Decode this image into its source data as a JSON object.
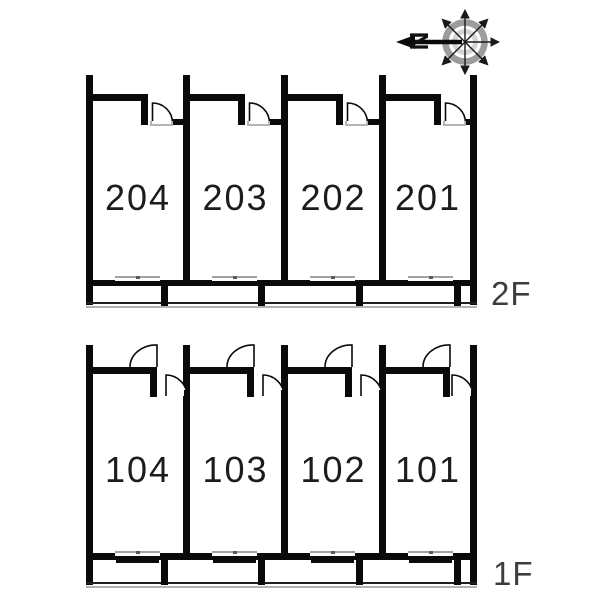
{
  "compass": {
    "north_label": "N"
  },
  "floors": [
    {
      "label": "2F",
      "units": [
        {
          "number": "204"
        },
        {
          "number": "203"
        },
        {
          "number": "202"
        },
        {
          "number": "201"
        }
      ]
    },
    {
      "label": "1F",
      "units": [
        {
          "number": "104"
        },
        {
          "number": "103"
        },
        {
          "number": "102"
        },
        {
          "number": "101"
        }
      ]
    }
  ],
  "colors": {
    "wall": "#0a0a0a",
    "window_line": "#a2a2a2",
    "railing_line": "#b2b2b2",
    "floor_label_text": "#3d3d3d",
    "unit_number_text": "#1c1c1c",
    "compass_outer_ring": "#9c9c9c",
    "compass_inner_ring": "#d4d4d4"
  }
}
